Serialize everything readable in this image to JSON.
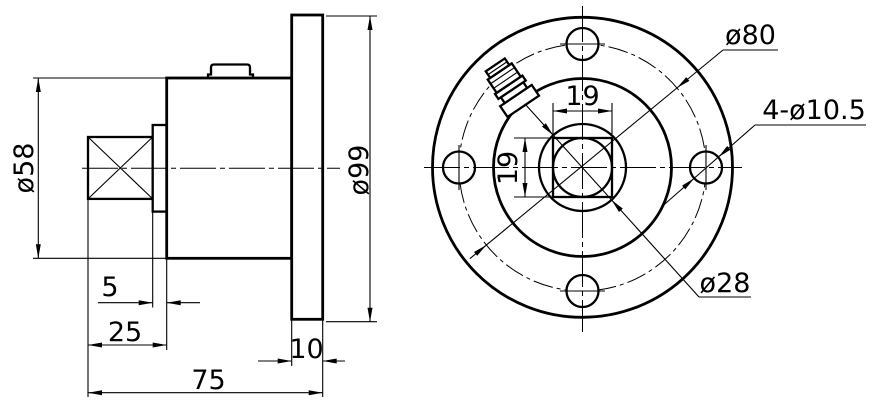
{
  "drawing": {
    "background": "#ffffff",
    "line_color": "#000000",
    "views": {
      "side_view": {
        "dims": {
          "body_diameter": "ø58",
          "flange_diameter": "ø99",
          "step_length": "5",
          "shaft_length": "25",
          "flange_thickness": "10",
          "total_length": "75"
        }
      },
      "front_view": {
        "dims": {
          "bolt_circle_diameter": "ø80",
          "bolt_holes": "4-ø10.5",
          "bore_diameter": "ø28",
          "square_width": "19",
          "square_height": "19"
        }
      }
    }
  }
}
